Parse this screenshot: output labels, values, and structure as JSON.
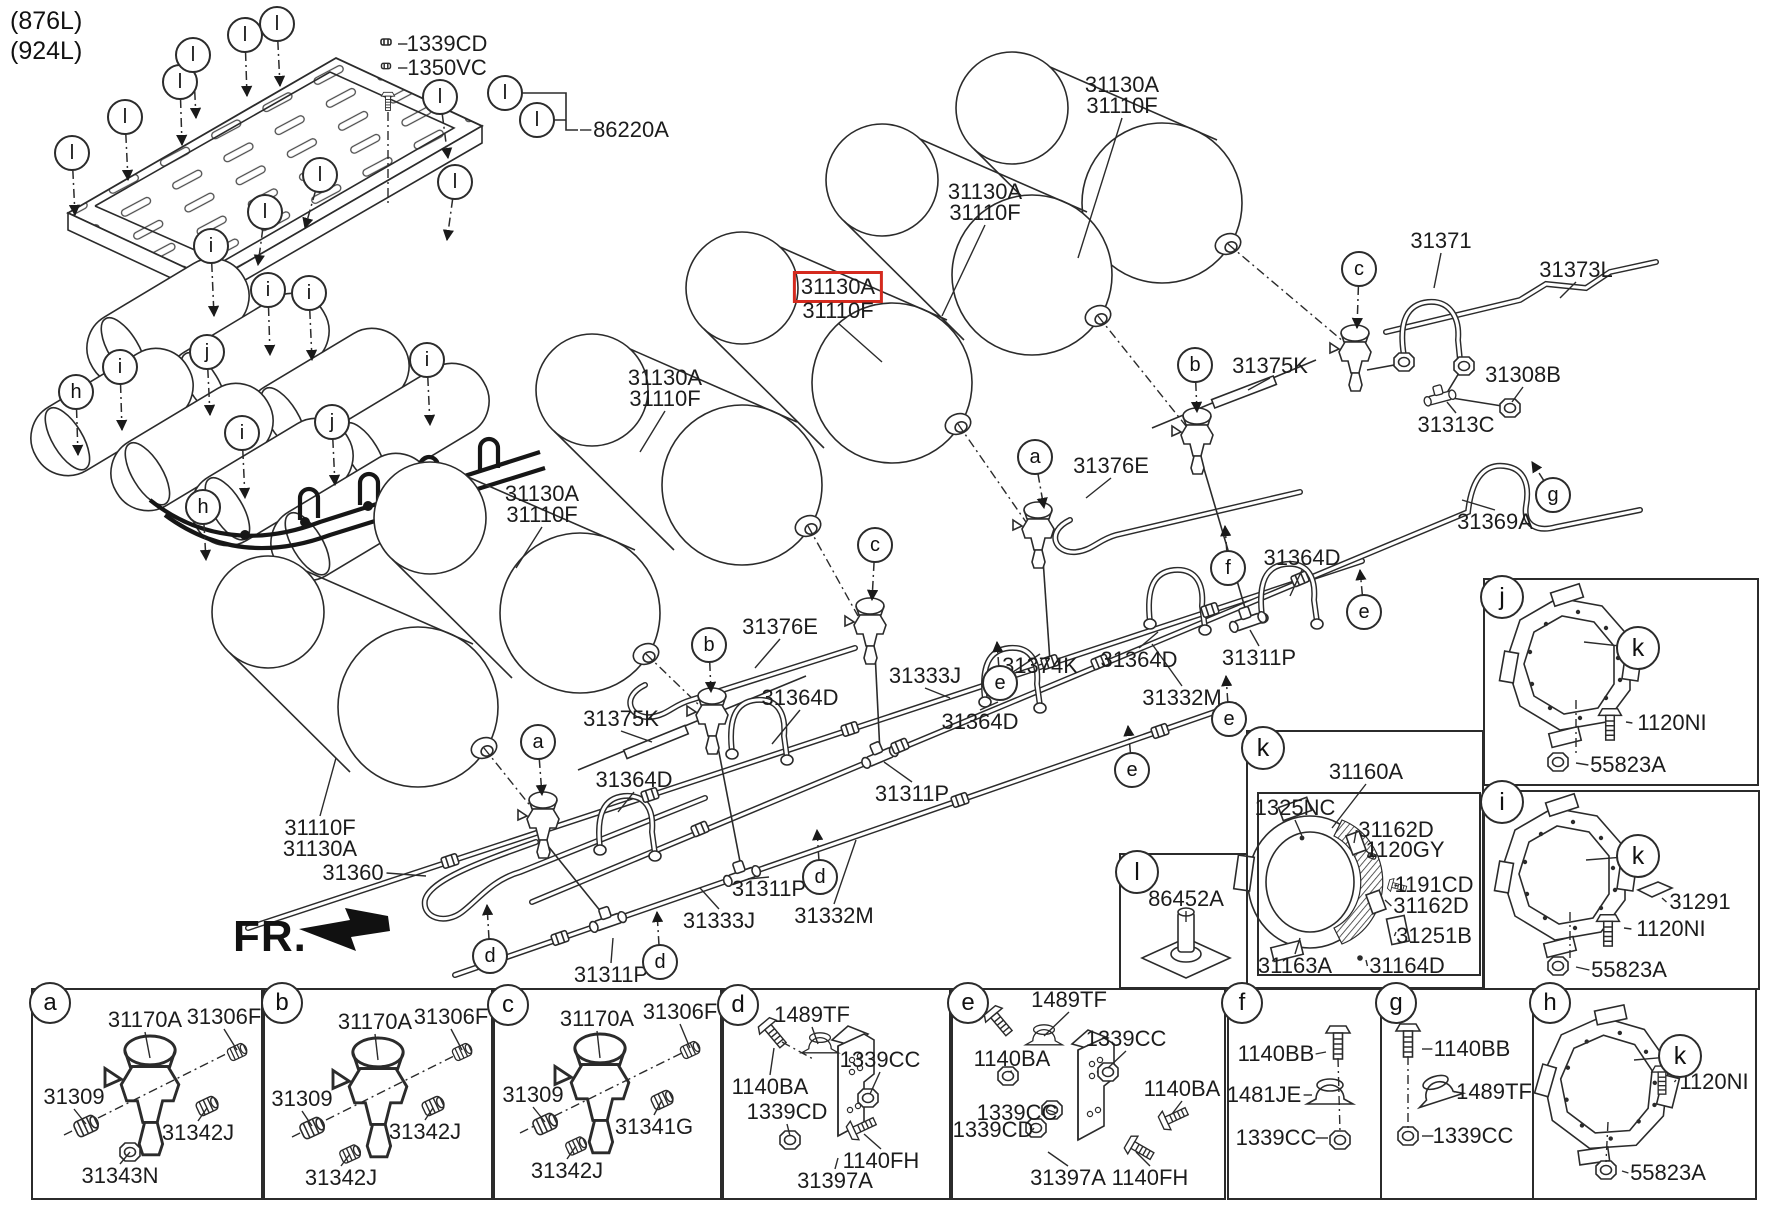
{
  "header": {
    "variant_1": "(876L)",
    "variant_2": "(924L)"
  },
  "fr_label": "FR.",
  "colors": {
    "highlight": "#d42a1e",
    "line": "#2b2b2b"
  },
  "highlighted_part": "31130A",
  "part_labels": [
    {
      "t": "1339CD",
      "x": 447,
      "y": 44,
      "side": "l",
      "lx": 398,
      "ly": 44
    },
    {
      "t": "1350VC",
      "x": 447,
      "y": 68,
      "side": "l",
      "lx": 398,
      "ly": 68
    },
    {
      "t": "86220A",
      "x": 631,
      "y": 130,
      "side": "l",
      "lx": 580,
      "ly": 130
    },
    {
      "t": "31130A",
      "x": 1122,
      "y": 85
    },
    {
      "t": "31110F",
      "x": 1122,
      "y": 106,
      "side": "b",
      "lx": 1078,
      "ly": 258
    },
    {
      "t": "31130A",
      "x": 985,
      "y": 192
    },
    {
      "t": "31110F",
      "x": 985,
      "y": 213,
      "side": "b",
      "lx": 942,
      "ly": 316
    },
    {
      "t": "31130A",
      "x": 838,
      "y": 287,
      "hl": true
    },
    {
      "t": "31110F",
      "x": 838,
      "y": 311,
      "side": "b",
      "lx": 882,
      "ly": 362
    },
    {
      "t": "31130A",
      "x": 665,
      "y": 378
    },
    {
      "t": "31110F",
      "x": 665,
      "y": 399,
      "side": "b",
      "lx": 640,
      "ly": 452
    },
    {
      "t": "31130A",
      "x": 542,
      "y": 494
    },
    {
      "t": "31110F",
      "x": 542,
      "y": 515,
      "side": "b",
      "lx": 516,
      "ly": 568
    },
    {
      "t": "31110F",
      "x": 320,
      "y": 828,
      "side": "t",
      "lx": 336,
      "ly": 758
    },
    {
      "t": "31130A",
      "x": 320,
      "y": 849
    },
    {
      "t": "31371",
      "x": 1441,
      "y": 241,
      "side": "b",
      "lx": 1434,
      "ly": 288
    },
    {
      "t": "31373L",
      "x": 1576,
      "y": 270,
      "side": "b",
      "lx": 1560,
      "ly": 298
    },
    {
      "t": "31308B",
      "x": 1523,
      "y": 375,
      "side": "b",
      "lx": 1512,
      "ly": 402
    },
    {
      "t": "31313C",
      "x": 1456,
      "y": 425,
      "side": "t",
      "lx": 1447,
      "ly": 402
    },
    {
      "t": "31369A",
      "x": 1495,
      "y": 522,
      "side": "t",
      "lx": 1462,
      "ly": 500
    },
    {
      "t": "31375K",
      "x": 1270,
      "y": 366,
      "side": "b",
      "lx": 1248,
      "ly": 390
    },
    {
      "t": "31375K",
      "x": 621,
      "y": 719,
      "side": "b",
      "lx": 652,
      "ly": 742
    },
    {
      "t": "31376E",
      "x": 1111,
      "y": 466,
      "side": "b",
      "lx": 1086,
      "ly": 498
    },
    {
      "t": "31376E",
      "x": 780,
      "y": 627,
      "side": "b",
      "lx": 755,
      "ly": 668
    },
    {
      "t": "31374K",
      "x": 1040,
      "y": 666,
      "side": "t",
      "lx": 1004,
      "ly": 678
    },
    {
      "t": "31364D",
      "x": 1302,
      "y": 558,
      "side": "b",
      "lx": 1290,
      "ly": 596
    },
    {
      "t": "31364D",
      "x": 1139,
      "y": 660,
      "side": "t",
      "lx": 1158,
      "ly": 632
    },
    {
      "t": "31364D",
      "x": 980,
      "y": 722,
      "side": "t",
      "lx": 998,
      "ly": 702
    },
    {
      "t": "31364D",
      "x": 800,
      "y": 698,
      "side": "b",
      "lx": 772,
      "ly": 744
    },
    {
      "t": "31364D",
      "x": 634,
      "y": 780,
      "side": "b",
      "lx": 618,
      "ly": 812
    },
    {
      "t": "31311P",
      "x": 1259,
      "y": 658,
      "side": "t",
      "lx": 1250,
      "ly": 630
    },
    {
      "t": "31311P",
      "x": 912,
      "y": 794,
      "side": "t",
      "lx": 884,
      "ly": 762
    },
    {
      "t": "31311P",
      "x": 769,
      "y": 889,
      "side": "t",
      "lx": 748,
      "ly": 879
    },
    {
      "t": "31311P",
      "x": 611,
      "y": 975,
      "side": "t",
      "lx": 613,
      "ly": 938
    },
    {
      "t": "31332M",
      "x": 1182,
      "y": 698,
      "side": "t",
      "lx": 1152,
      "ly": 644
    },
    {
      "t": "31332M",
      "x": 834,
      "y": 916,
      "side": "t",
      "lx": 856,
      "ly": 840
    },
    {
      "t": "31333J",
      "x": 925,
      "y": 676,
      "side": "b",
      "lx": 950,
      "ly": 698
    },
    {
      "t": "31333J",
      "x": 719,
      "y": 921,
      "side": "t",
      "lx": 700,
      "ly": 888
    },
    {
      "t": "31360",
      "x": 353,
      "y": 873,
      "side": "r",
      "lx": 426,
      "ly": 876
    },
    {
      "t": "31160A",
      "x": 1366,
      "y": 772,
      "side": "b",
      "lx": 1332,
      "ly": 828
    },
    {
      "t": "1325NC",
      "x": 1295,
      "y": 808,
      "side": "b",
      "lx": 1302,
      "ly": 836
    },
    {
      "t": "31162D",
      "x": 1396,
      "y": 830,
      "side": "l",
      "lx": 1354,
      "ly": 843
    },
    {
      "t": "1120GY",
      "x": 1405,
      "y": 850,
      "side": "l",
      "lx": 1372,
      "ly": 856
    },
    {
      "t": "1191CD",
      "x": 1434,
      "y": 885,
      "side": "l",
      "lx": 1398,
      "ly": 886
    },
    {
      "t": "31162D",
      "x": 1431,
      "y": 906,
      "side": "l",
      "lx": 1385,
      "ly": 900
    },
    {
      "t": "31251B",
      "x": 1434,
      "y": 936,
      "side": "l",
      "lx": 1396,
      "ly": 932
    },
    {
      "t": "31163A",
      "x": 1295,
      "y": 966,
      "side": "t",
      "lx": 1300,
      "ly": 938
    },
    {
      "t": "31164D",
      "x": 1407,
      "y": 966,
      "side": "l",
      "lx": 1366,
      "ly": 960
    },
    {
      "t": "86452A",
      "x": 1186,
      "y": 899,
      "side": "b",
      "lx": 1186,
      "ly": 922
    },
    {
      "t": "1120NI",
      "x": 1672,
      "y": 723,
      "side": "l",
      "lx": 1626,
      "ly": 722
    },
    {
      "t": "55823A",
      "x": 1628,
      "y": 765,
      "side": "l",
      "lx": 1576,
      "ly": 763
    },
    {
      "t": "31291",
      "x": 1700,
      "y": 902,
      "side": "l",
      "lx": 1662,
      "ly": 898
    },
    {
      "t": "1120NI",
      "x": 1671,
      "y": 929,
      "side": "l",
      "lx": 1624,
      "ly": 928
    },
    {
      "t": "55823A",
      "x": 1629,
      "y": 970,
      "side": "l",
      "lx": 1576,
      "ly": 967
    },
    {
      "t": "1120NI",
      "x": 1714,
      "y": 1082,
      "side": "l",
      "lx": 1676,
      "ly": 1080
    },
    {
      "t": "55823A",
      "x": 1668,
      "y": 1173,
      "side": "l",
      "lx": 1622,
      "ly": 1171
    },
    {
      "t": "31170A",
      "x": 145,
      "y": 1020,
      "side": "b",
      "lx": 150,
      "ly": 1058
    },
    {
      "t": "31306F",
      "x": 224,
      "y": 1017,
      "side": "b",
      "lx": 237,
      "ly": 1050
    },
    {
      "t": "31309",
      "x": 74,
      "y": 1097,
      "side": "b",
      "lx": 86,
      "ly": 1124
    },
    {
      "t": "31342J",
      "x": 198,
      "y": 1133,
      "side": "t",
      "lx": 207,
      "ly": 1108
    },
    {
      "t": "31343N",
      "x": 120,
      "y": 1176,
      "side": "t",
      "lx": 130,
      "ly": 1152
    },
    {
      "t": "31170A",
      "x": 375,
      "y": 1022,
      "side": "b",
      "lx": 378,
      "ly": 1060
    },
    {
      "t": "31306F",
      "x": 451,
      "y": 1017,
      "side": "b",
      "lx": 462,
      "ly": 1050
    },
    {
      "t": "31309",
      "x": 302,
      "y": 1099,
      "side": "b",
      "lx": 312,
      "ly": 1126
    },
    {
      "t": "31342J",
      "x": 425,
      "y": 1132,
      "side": "t",
      "lx": 433,
      "ly": 1108
    },
    {
      "t": "31342J",
      "x": 341,
      "y": 1178,
      "side": "t",
      "lx": 350,
      "ly": 1154
    },
    {
      "t": "31170A",
      "x": 597,
      "y": 1019,
      "side": "b",
      "lx": 600,
      "ly": 1058
    },
    {
      "t": "31306F",
      "x": 680,
      "y": 1012,
      "side": "b",
      "lx": 690,
      "ly": 1048
    },
    {
      "t": "31309",
      "x": 533,
      "y": 1095,
      "side": "b",
      "lx": 545,
      "ly": 1122
    },
    {
      "t": "31341G",
      "x": 654,
      "y": 1127,
      "side": "t",
      "lx": 662,
      "ly": 1100
    },
    {
      "t": "31342J",
      "x": 567,
      "y": 1171,
      "side": "t",
      "lx": 576,
      "ly": 1146
    },
    {
      "t": "1489TF",
      "x": 812,
      "y": 1015,
      "side": "b",
      "lx": 818,
      "ly": 1044
    },
    {
      "t": "1140BA",
      "x": 770,
      "y": 1087,
      "side": "t",
      "lx": 774,
      "ly": 1048
    },
    {
      "t": "1339CC",
      "x": 880,
      "y": 1060,
      "side": "b",
      "lx": 870,
      "ly": 1094
    },
    {
      "t": "1339CD",
      "x": 787,
      "y": 1112,
      "side": "b",
      "lx": 790,
      "ly": 1136
    },
    {
      "t": "1140FH",
      "x": 881,
      "y": 1161,
      "side": "t",
      "lx": 864,
      "ly": 1134
    },
    {
      "t": "31397A",
      "x": 835,
      "y": 1181,
      "side": "t",
      "lx": 838,
      "ly": 1158
    },
    {
      "t": "1489TF",
      "x": 1069,
      "y": 1000,
      "side": "b",
      "lx": 1044,
      "ly": 1036
    },
    {
      "t": "1140BA",
      "x": 1012,
      "y": 1059,
      "side": "b",
      "lx": 1008,
      "ly": 1072
    },
    {
      "t": "1339CC",
      "x": 1126,
      "y": 1039,
      "side": "b",
      "lx": 1108,
      "ly": 1068
    },
    {
      "t": "1140BA",
      "x": 1182,
      "y": 1089,
      "side": "b",
      "lx": 1172,
      "ly": 1114
    },
    {
      "t": "1339CC",
      "x": 1017,
      "y": 1113,
      "side": "r",
      "lx": 1048,
      "ly": 1110
    },
    {
      "t": "1339CD",
      "x": 993,
      "y": 1130,
      "side": "r",
      "lx": 1034,
      "ly": 1128
    },
    {
      "t": "31397A",
      "x": 1068,
      "y": 1178,
      "side": "t",
      "lx": 1048,
      "ly": 1152
    },
    {
      "t": "1140FH",
      "x": 1150,
      "y": 1178,
      "side": "t",
      "lx": 1136,
      "ly": 1152
    },
    {
      "t": "1140BB",
      "x": 1276,
      "y": 1054,
      "side": "r",
      "lx": 1326,
      "ly": 1052
    },
    {
      "t": "1481JE",
      "x": 1264,
      "y": 1095,
      "side": "r",
      "lx": 1312,
      "ly": 1095
    },
    {
      "t": "1339CC",
      "x": 1276,
      "y": 1138,
      "side": "r",
      "lx": 1328,
      "ly": 1138
    },
    {
      "t": "1140BB",
      "x": 1472,
      "y": 1049,
      "side": "l",
      "lx": 1422,
      "ly": 1049
    },
    {
      "t": "1489TF",
      "x": 1494,
      "y": 1092,
      "side": "l",
      "lx": 1454,
      "ly": 1092
    },
    {
      "t": "1339CC",
      "x": 1473,
      "y": 1136,
      "side": "l",
      "lx": 1422,
      "ly": 1136
    }
  ],
  "callouts": [
    {
      "l": "l",
      "x": 72,
      "y": 153,
      "ax": 75,
      "ay": 215
    },
    {
      "l": "l",
      "x": 125,
      "y": 117,
      "ax": 128,
      "ay": 180
    },
    {
      "l": "l",
      "x": 180,
      "y": 82,
      "ax": 182,
      "ay": 145
    },
    {
      "l": "l",
      "x": 193,
      "y": 55,
      "ax": 196,
      "ay": 118
    },
    {
      "l": "l",
      "x": 245,
      "y": 35,
      "ax": 247,
      "ay": 96
    },
    {
      "l": "l",
      "x": 277,
      "y": 24,
      "ax": 280,
      "ay": 86
    },
    {
      "l": "l",
      "x": 320,
      "y": 175,
      "ax": 305,
      "ay": 228
    },
    {
      "l": "l",
      "x": 265,
      "y": 212,
      "ax": 258,
      "ay": 265
    },
    {
      "l": "l",
      "x": 440,
      "y": 97,
      "ax": 448,
      "ay": 158
    },
    {
      "l": "l",
      "x": 505,
      "y": 93
    },
    {
      "l": "l",
      "x": 537,
      "y": 120
    },
    {
      "l": "l",
      "x": 455,
      "y": 182,
      "ax": 447,
      "ay": 240
    },
    {
      "l": "i",
      "x": 211,
      "y": 246,
      "ax": 214,
      "ay": 316
    },
    {
      "l": "i",
      "x": 268,
      "y": 290,
      "ax": 270,
      "ay": 355
    },
    {
      "l": "i",
      "x": 309,
      "y": 293,
      "ax": 312,
      "ay": 360
    },
    {
      "l": "j",
      "x": 207,
      "y": 352,
      "ax": 210,
      "ay": 415
    },
    {
      "l": "i",
      "x": 120,
      "y": 367,
      "ax": 122,
      "ay": 430
    },
    {
      "l": "h",
      "x": 76,
      "y": 392,
      "ax": 78,
      "ay": 455
    },
    {
      "l": "i",
      "x": 427,
      "y": 360,
      "ax": 430,
      "ay": 425
    },
    {
      "l": "j",
      "x": 332,
      "y": 422,
      "ax": 335,
      "ay": 485
    },
    {
      "l": "i",
      "x": 242,
      "y": 433,
      "ax": 245,
      "ay": 498
    },
    {
      "l": "h",
      "x": 203,
      "y": 507,
      "ax": 206,
      "ay": 560
    },
    {
      "l": "a",
      "x": 1035,
      "y": 457,
      "ax": 1044,
      "ay": 508
    },
    {
      "l": "a",
      "x": 538,
      "y": 742,
      "ax": 542,
      "ay": 795
    },
    {
      "l": "b",
      "x": 1195,
      "y": 365,
      "ax": 1197,
      "ay": 412
    },
    {
      "l": "b",
      "x": 709,
      "y": 645,
      "ax": 711,
      "ay": 692
    },
    {
      "l": "c",
      "x": 1359,
      "y": 269,
      "ax": 1357,
      "ay": 328
    },
    {
      "l": "c",
      "x": 875,
      "y": 545,
      "ax": 872,
      "ay": 600
    },
    {
      "l": "d",
      "x": 490,
      "y": 956,
      "ax": 487,
      "ay": 905
    },
    {
      "l": "d",
      "x": 660,
      "y": 962,
      "ax": 657,
      "ay": 912
    },
    {
      "l": "d",
      "x": 820,
      "y": 877,
      "ax": 817,
      "ay": 830
    },
    {
      "l": "e",
      "x": 1000,
      "y": 683,
      "ax": 997,
      "ay": 642
    },
    {
      "l": "e",
      "x": 1132,
      "y": 770,
      "ax": 1128,
      "ay": 726
    },
    {
      "l": "e",
      "x": 1229,
      "y": 719,
      "ax": 1226,
      "ay": 676
    },
    {
      "l": "e",
      "x": 1364,
      "y": 612,
      "ax": 1360,
      "ay": 570
    },
    {
      "l": "f",
      "x": 1228,
      "y": 568,
      "ax": 1225,
      "ay": 526
    },
    {
      "l": "g",
      "x": 1553,
      "y": 495,
      "ax": 1532,
      "ay": 462
    },
    {
      "l": "j",
      "x": 1502,
      "y": 597,
      "d": 40
    },
    {
      "l": "k",
      "x": 1638,
      "y": 648,
      "d": 40,
      "ax": 1584,
      "ay": 642,
      "solid": true
    },
    {
      "l": "i",
      "x": 1502,
      "y": 802,
      "d": 40
    },
    {
      "l": "k",
      "x": 1638,
      "y": 856,
      "d": 40,
      "ax": 1586,
      "ay": 860,
      "solid": true
    },
    {
      "l": "l",
      "x": 1137,
      "y": 872,
      "d": 40
    },
    {
      "l": "k",
      "x": 1263,
      "y": 748,
      "d": 40
    },
    {
      "l": "a",
      "x": 50,
      "y": 1003,
      "d": 38
    },
    {
      "l": "b",
      "x": 282,
      "y": 1003,
      "d": 38
    },
    {
      "l": "c",
      "x": 508,
      "y": 1005,
      "d": 38
    },
    {
      "l": "d",
      "x": 738,
      "y": 1005,
      "d": 38
    },
    {
      "l": "e",
      "x": 968,
      "y": 1003,
      "d": 38
    },
    {
      "l": "f",
      "x": 1242,
      "y": 1003,
      "d": 38
    },
    {
      "l": "g",
      "x": 1396,
      "y": 1003,
      "d": 38
    },
    {
      "l": "h",
      "x": 1550,
      "y": 1003,
      "d": 38
    },
    {
      "l": "k",
      "x": 1680,
      "y": 1056,
      "d": 40,
      "ax": 1634,
      "ay": 1060,
      "solid": true
    }
  ]
}
